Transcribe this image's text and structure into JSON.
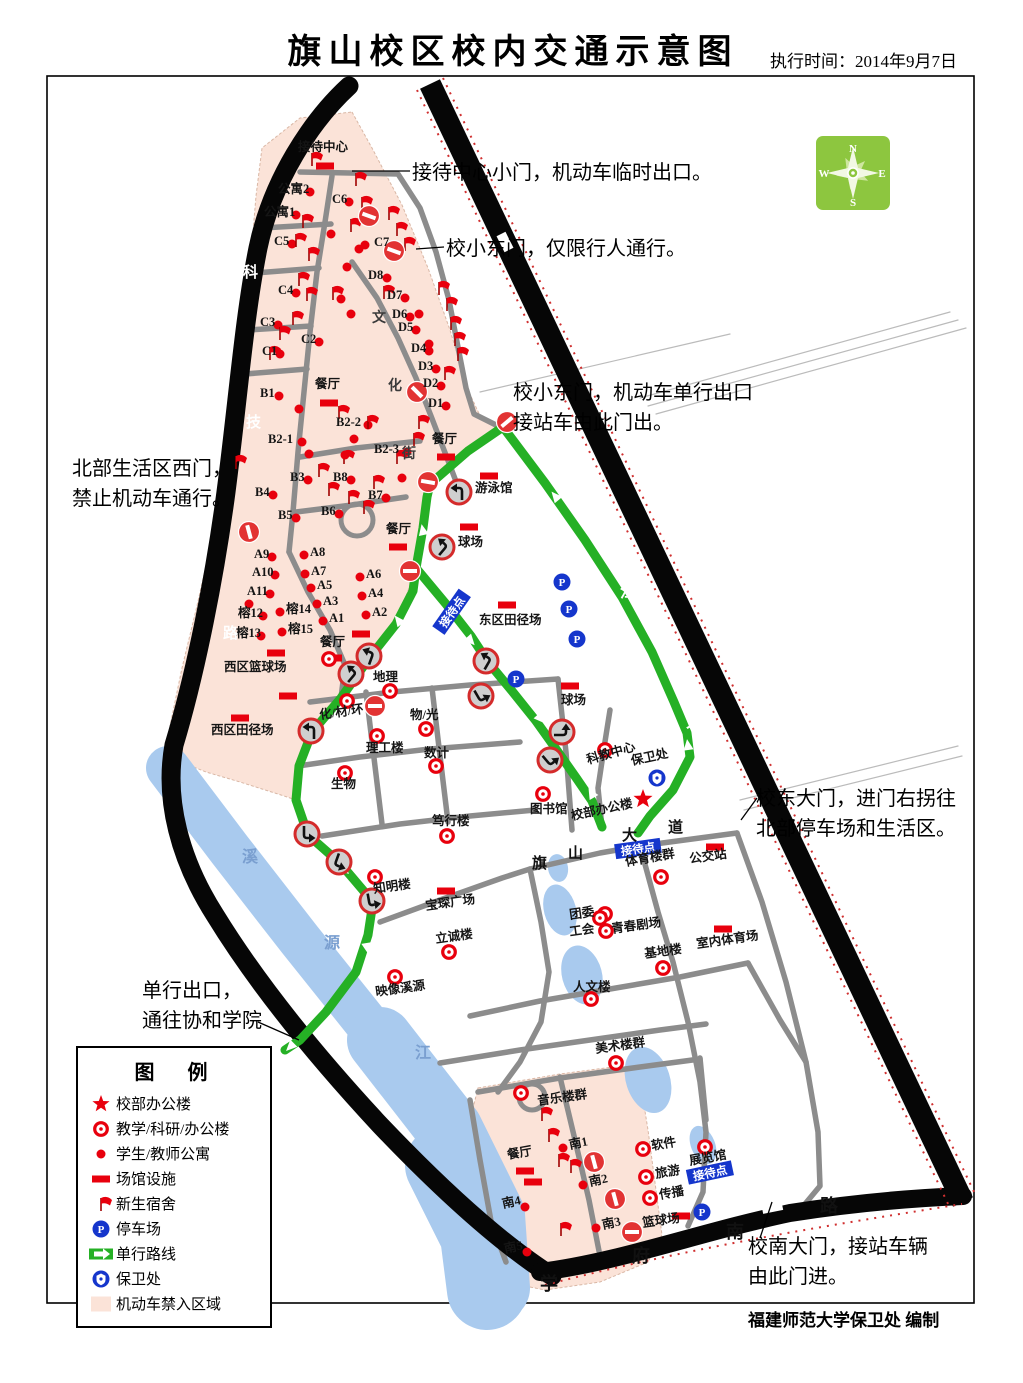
{
  "title": "旗山校区校内交通示意图",
  "subtitle": "执行时间：2014年9月7日",
  "credit": "福建师范大学保卫处  编制",
  "compass": {
    "n": "N",
    "e": "E",
    "s": "S",
    "w": "W"
  },
  "colors": {
    "red": "#e8000d",
    "blue": "#1536cc",
    "green_route": "#25b025",
    "pink_zone": "#fbe3d8",
    "river": "#a9caee",
    "road_black": "#060606",
    "road_gray": "#8c8c8c",
    "compass_green": "#8dc63f"
  },
  "legend": {
    "title": "图  例",
    "items": [
      {
        "icon": "star",
        "label": "校部办公楼"
      },
      {
        "icon": "donut",
        "label": "教学/科研/办公楼"
      },
      {
        "icon": "dot",
        "label": "学生/教师公寓"
      },
      {
        "icon": "rect",
        "label": "场馆设施"
      },
      {
        "icon": "flag",
        "label": "新生宿舍"
      },
      {
        "icon": "p",
        "label": "停车场"
      },
      {
        "icon": "oneway",
        "label": "单行路线"
      },
      {
        "icon": "badge",
        "label": "保卫处"
      },
      {
        "icon": "zone",
        "label": "机动车禁入区域"
      }
    ]
  },
  "annotations": [
    {
      "x": 412,
      "y": 158,
      "lines": [
        "接待中心小门，机动车临时出口。"
      ]
    },
    {
      "x": 446,
      "y": 234,
      "lines": [
        "校小东门，仅限行人通行。"
      ]
    },
    {
      "x": 513,
      "y": 378,
      "lines": [
        "校小东门，机动车单行出口",
        "接站车由此门出。"
      ]
    },
    {
      "x": 72,
      "y": 454,
      "lines": [
        "北部生活区西门，",
        "禁止机动车通行。"
      ]
    },
    {
      "x": 756,
      "y": 784,
      "lines": [
        "校东大门，进门右拐往",
        "北部停车场和生活区。"
      ]
    },
    {
      "x": 142,
      "y": 976,
      "lines": [
        "单行出口，",
        "通往协和学院"
      ]
    },
    {
      "x": 748,
      "y": 1232,
      "lines": [
        "校南大门，接站车辆",
        "由此门进。"
      ]
    }
  ],
  "road_chars": [
    {
      "ch": "乌",
      "x": 586,
      "y": 289,
      "c": "#ffffff",
      "s": 16
    },
    {
      "ch": "龙",
      "x": 552,
      "y": 460,
      "c": "#ffffff",
      "s": 16
    },
    {
      "ch": "江",
      "x": 620,
      "y": 597,
      "c": "#ffffff",
      "s": 16
    },
    {
      "ch": "大",
      "x": 686,
      "y": 727,
      "c": "#ffffff",
      "s": 16
    },
    {
      "ch": "道",
      "x": 772,
      "y": 907,
      "c": "#ffffff",
      "s": 16
    },
    {
      "ch": "科",
      "x": 243,
      "y": 277,
      "c": "#ffffff",
      "s": 15
    },
    {
      "ch": "技",
      "x": 246,
      "y": 427,
      "c": "#ffffff",
      "s": 15
    },
    {
      "ch": "路",
      "x": 223,
      "y": 638,
      "c": "#ffffff",
      "s": 15
    },
    {
      "ch": "学",
      "x": 540,
      "y": 1290,
      "c": "#111111",
      "s": 18
    },
    {
      "ch": "府",
      "x": 632,
      "y": 1262,
      "c": "#111111",
      "s": 18
    },
    {
      "ch": "南",
      "x": 726,
      "y": 1238,
      "c": "#111111",
      "s": 18
    },
    {
      "ch": "路",
      "x": 820,
      "y": 1212,
      "c": "#111111",
      "s": 18
    },
    {
      "ch": "文",
      "x": 372,
      "y": 322,
      "c": "#3a3a3a",
      "s": 14
    },
    {
      "ch": "化",
      "x": 388,
      "y": 390,
      "c": "#3a3a3a",
      "s": 14
    },
    {
      "ch": "街",
      "x": 402,
      "y": 458,
      "c": "#3a3a3a",
      "s": 14
    },
    {
      "ch": "旗",
      "x": 532,
      "y": 868,
      "c": "#111111",
      "s": 15
    },
    {
      "ch": "山",
      "x": 568,
      "y": 858,
      "c": "#111111",
      "s": 15
    },
    {
      "ch": "大",
      "x": 622,
      "y": 840,
      "c": "#111111",
      "s": 15
    },
    {
      "ch": "道",
      "x": 668,
      "y": 832,
      "c": "#111111",
      "s": 15
    },
    {
      "ch": "溪",
      "x": 242,
      "y": 862,
      "c": "#7a9fd0",
      "s": 16
    },
    {
      "ch": "源",
      "x": 324,
      "y": 948,
      "c": "#7a9fd0",
      "s": 16
    },
    {
      "ch": "江",
      "x": 415,
      "y": 1058,
      "c": "#7a9fd0",
      "s": 16
    }
  ],
  "map": {
    "labels": [
      [
        "接待中心",
        298,
        147,
        "rect",
        325,
        166,
        0
      ],
      [
        "公寓2",
        278,
        189,
        "dot",
        310,
        192,
        0
      ],
      [
        "公寓1",
        264,
        212,
        "dot",
        296,
        215,
        0
      ],
      [
        "C6",
        332,
        199,
        "dot",
        349,
        202,
        0
      ],
      [
        "C5",
        274,
        241,
        "dot",
        292,
        244,
        0
      ],
      [
        "C7",
        374,
        242,
        "dot",
        365,
        245,
        0
      ],
      [
        "C4",
        278,
        290,
        "dot",
        296,
        293,
        0
      ],
      [
        "C3",
        260,
        322,
        "dot",
        278,
        325,
        0
      ],
      [
        "C2",
        301,
        339,
        "dot",
        319,
        342,
        0
      ],
      [
        "C1",
        262,
        351,
        "dot",
        280,
        354,
        0
      ],
      [
        "D8",
        368,
        275,
        "dot",
        387,
        278,
        0
      ],
      [
        "D7",
        387,
        295,
        "dot",
        405,
        298,
        0
      ],
      [
        "D6",
        392,
        314,
        "dot",
        410,
        317,
        0
      ],
      [
        "D5",
        398,
        327,
        "dot",
        416,
        330,
        0
      ],
      [
        "D4",
        411,
        348,
        "dot",
        429,
        351,
        0
      ],
      [
        "D3",
        418,
        366,
        "dot",
        436,
        369,
        0
      ],
      [
        "D2",
        423,
        383,
        "dot",
        441,
        386,
        0
      ],
      [
        "D1",
        428,
        403,
        "dot",
        446,
        406,
        0
      ],
      [
        "B1",
        260,
        393,
        "dot",
        279,
        396,
        0
      ],
      [
        "餐厅",
        315,
        384,
        "rect",
        329,
        403,
        0
      ],
      [
        "B2-2",
        336,
        422,
        "dot",
        368,
        425,
        0
      ],
      [
        "B2-1",
        268,
        439,
        "dot",
        302,
        442,
        0
      ],
      [
        "B2-3",
        374,
        449,
        "dot",
        407,
        452,
        0
      ],
      [
        "餐厅",
        432,
        439,
        "rect",
        446,
        457,
        0
      ],
      [
        "B3",
        290,
        477,
        "dot",
        308,
        480,
        0
      ],
      [
        "B8",
        333,
        477,
        "dot",
        351,
        480,
        0
      ],
      [
        "B7",
        368,
        495,
        "dot",
        386,
        498,
        0
      ],
      [
        "B4",
        255,
        492,
        "dot",
        273,
        495,
        0
      ],
      [
        "B5",
        278,
        515,
        "dot",
        296,
        518,
        0
      ],
      [
        "B6",
        321,
        511,
        "dot",
        339,
        514,
        0
      ],
      [
        "餐厅",
        386,
        529,
        "rect",
        398,
        547,
        0
      ],
      [
        "A9",
        254,
        554,
        "dot",
        272,
        557,
        0
      ],
      [
        "A10",
        252,
        572,
        "dot",
        275,
        575,
        0
      ],
      [
        "A11",
        247,
        591,
        "dot",
        270,
        594,
        0
      ],
      [
        "榕12",
        238,
        613,
        "dot",
        263,
        616,
        0
      ],
      [
        "榕13",
        236,
        633,
        "dot",
        261,
        636,
        0
      ],
      [
        "榕14",
        286,
        609,
        "dot",
        280,
        612,
        0
      ],
      [
        "榕15",
        288,
        629,
        "dot",
        282,
        632,
        0
      ],
      [
        "A8",
        310,
        552,
        "dot",
        304,
        555,
        0
      ],
      [
        "A7",
        311,
        571,
        "dot",
        305,
        574,
        0
      ],
      [
        "A5",
        317,
        585,
        "dot",
        311,
        588,
        0
      ],
      [
        "A3",
        323,
        601,
        "dot",
        317,
        604,
        0
      ],
      [
        "A1",
        329,
        618,
        "dot",
        323,
        621,
        0
      ],
      [
        "A6",
        366,
        574,
        "dot",
        360,
        577,
        0
      ],
      [
        "A4",
        368,
        593,
        "dot",
        362,
        596,
        0
      ],
      [
        "A2",
        372,
        612,
        "dot",
        366,
        615,
        0
      ],
      [
        "餐厅",
        320,
        642,
        "rect",
        333,
        658,
        0
      ],
      [
        "西区篮球场",
        224,
        667,
        "rect",
        276,
        653,
        0
      ],
      [
        "西区田径场",
        211,
        730,
        "rect",
        240,
        718,
        0
      ],
      [
        "游泳馆",
        475,
        488,
        "rect",
        489,
        476,
        0
      ],
      [
        "球场",
        458,
        542,
        "rect",
        469,
        527,
        0
      ],
      [
        "东区田径场",
        479,
        620,
        "rect",
        507,
        605,
        0
      ],
      [
        "球场",
        561,
        700,
        "rect",
        570,
        686,
        0
      ],
      [
        "地理",
        373,
        677,
        "donut",
        390,
        691,
        0
      ],
      [
        "化/材/环",
        320,
        715,
        "donut",
        347,
        701,
        -8
      ],
      [
        "物/光",
        410,
        715,
        "donut",
        426,
        729,
        0
      ],
      [
        "理工楼",
        366,
        748,
        "donut",
        377,
        736,
        0
      ],
      [
        "数计",
        424,
        753,
        "donut",
        436,
        766,
        0
      ],
      [
        "生物",
        331,
        784,
        "donut",
        345,
        773,
        0
      ],
      [
        "笃行楼",
        432,
        821,
        "donut",
        447,
        836,
        0
      ],
      [
        "图书馆",
        530,
        809,
        "donut",
        543,
        794,
        0
      ],
      [
        "知明楼",
        374,
        889,
        "donut",
        375,
        877,
        -8
      ],
      [
        "宝琛广场",
        426,
        906,
        "rect",
        446,
        891,
        -8
      ],
      [
        "立诚楼",
        436,
        939,
        "donut",
        449,
        952,
        -8
      ],
      [
        "映像溪源",
        376,
        992,
        "donut",
        395,
        977,
        -8
      ],
      [
        "人文楼",
        573,
        987,
        "donut",
        591,
        999,
        0
      ],
      [
        "基地楼",
        645,
        954,
        "donut",
        663,
        968,
        -8
      ],
      [
        "室内体育场",
        697,
        944,
        "rect",
        723,
        929,
        -8
      ],
      [
        "美术楼群",
        596,
        1049,
        "donut",
        616,
        1063,
        -8
      ],
      [
        "音乐楼群",
        538,
        1101,
        "donut",
        521,
        1093,
        -8
      ],
      [
        "科教中心",
        588,
        760,
        "donut",
        605,
        750,
        -16
      ],
      [
        "保卫处",
        632,
        761,
        "badge",
        657,
        778,
        -12
      ],
      [
        "校部办公楼",
        572,
        816,
        "star",
        643,
        799,
        -12
      ],
      [
        "体育楼群",
        626,
        862,
        "donut",
        661,
        877,
        -10
      ],
      [
        "公交站",
        690,
        859,
        "rect",
        715,
        847,
        -8
      ],
      [
        "团委",
        570,
        915,
        "donut",
        605,
        914,
        -8
      ],
      [
        "工会",
        570,
        932,
        "donut",
        606,
        931,
        -8
      ],
      [
        "青春剧场",
        612,
        929,
        "donut",
        600,
        918,
        -8
      ],
      [
        "餐厅",
        508,
        1155,
        "rect",
        525,
        1171,
        -10
      ],
      [
        "南1",
        570,
        1145,
        "dot",
        563,
        1148,
        -12
      ],
      [
        "南2",
        590,
        1182,
        "dot",
        583,
        1185,
        -12
      ],
      [
        "南3",
        603,
        1225,
        "dot",
        596,
        1228,
        -12
      ],
      [
        "南4",
        503,
        1204,
        "dot",
        525,
        1207,
        -12
      ],
      [
        "南5",
        505,
        1249,
        "dot",
        527,
        1252,
        -12
      ],
      [
        "软件",
        652,
        1146,
        "donut",
        643,
        1149,
        -10
      ],
      [
        "旅游",
        656,
        1174,
        "donut",
        646,
        1177,
        -10
      ],
      [
        "传播",
        660,
        1195,
        "donut",
        650,
        1198,
        -10
      ],
      [
        "展览馆",
        690,
        1161,
        "donut",
        705,
        1147,
        -10
      ],
      [
        "篮球场",
        643,
        1223,
        "rect",
        681,
        1216,
        -8
      ]
    ],
    "flags": [
      [
        312,
        166
      ],
      [
        356,
        186
      ],
      [
        362,
        210
      ],
      [
        351,
        232
      ],
      [
        303,
        228
      ],
      [
        296,
        247
      ],
      [
        309,
        261
      ],
      [
        299,
        286
      ],
      [
        307,
        301
      ],
      [
        389,
        220
      ],
      [
        397,
        236
      ],
      [
        405,
        251
      ],
      [
        439,
        295
      ],
      [
        447,
        311
      ],
      [
        451,
        330
      ],
      [
        455,
        346
      ],
      [
        458,
        361
      ],
      [
        445,
        380
      ],
      [
        333,
        300
      ],
      [
        293,
        325
      ],
      [
        280,
        340
      ],
      [
        270,
        360
      ],
      [
        339,
        419
      ],
      [
        368,
        429
      ],
      [
        419,
        429
      ],
      [
        414,
        446
      ],
      [
        397,
        464
      ],
      [
        344,
        464
      ],
      [
        319,
        477
      ],
      [
        329,
        496
      ],
      [
        349,
        504
      ],
      [
        364,
        514
      ],
      [
        374,
        489
      ],
      [
        236,
        469
      ],
      [
        384,
        299
      ],
      [
        542,
        1121
      ],
      [
        549,
        1142
      ],
      [
        559,
        1167
      ],
      [
        571,
        1173
      ],
      [
        561,
        1236
      ]
    ],
    "extra_dots": [
      [
        331,
        234
      ],
      [
        359,
        249
      ],
      [
        347,
        267
      ],
      [
        341,
        299
      ],
      [
        351,
        314
      ],
      [
        419,
        314
      ],
      [
        429,
        344
      ],
      [
        299,
        409
      ],
      [
        309,
        454
      ],
      [
        354,
        439
      ],
      [
        249,
        604
      ],
      [
        345,
        455
      ],
      [
        402,
        478
      ]
    ],
    "extra_rects": [
      [
        361,
        634
      ],
      [
        533,
        1182
      ],
      [
        288,
        696
      ]
    ],
    "extra_donuts": [
      [
        329,
        659
      ]
    ],
    "parking": {
      "label": "P",
      "positions": [
        [
          562,
          582
        ],
        [
          569,
          609
        ],
        [
          577,
          639
        ],
        [
          516,
          679
        ],
        [
          702,
          1212
        ]
      ]
    },
    "reception_tags": {
      "text": "接待点",
      "positions": [
        [
          452,
          612,
          -55
        ],
        [
          638,
          849,
          -8
        ],
        [
          710,
          1173,
          -12
        ]
      ]
    },
    "no_entry": [
      [
        369,
        216,
        20
      ],
      [
        394,
        251,
        20
      ],
      [
        417,
        392,
        45
      ],
      [
        249,
        532,
        75
      ],
      [
        507,
        422,
        -40
      ],
      [
        428,
        482,
        10
      ],
      [
        410,
        571,
        0
      ],
      [
        375,
        706,
        0
      ],
      [
        594,
        1162,
        75
      ],
      [
        615,
        1199,
        75
      ],
      [
        632,
        1232,
        0
      ]
    ],
    "turn_signs": [
      [
        459,
        492,
        0
      ],
      [
        442,
        547,
        40
      ],
      [
        486,
        661,
        30
      ],
      [
        481,
        696,
        150
      ],
      [
        369,
        656,
        20
      ],
      [
        351,
        674,
        40
      ],
      [
        311,
        731,
        0
      ],
      [
        562,
        732,
        90
      ],
      [
        550,
        760,
        140
      ],
      [
        307,
        834,
        180
      ],
      [
        339,
        862,
        200
      ],
      [
        372,
        901,
        170
      ]
    ],
    "route_arrows": [
      [
        423,
        531,
        -12
      ],
      [
        399,
        621,
        -38
      ],
      [
        344,
        869,
        135
      ],
      [
        367,
        947,
        170
      ],
      [
        291,
        1046,
        225
      ],
      [
        556,
        497,
        -40
      ],
      [
        688,
        746,
        -8
      ],
      [
        592,
        794,
        -30
      ],
      [
        540,
        718,
        138
      ],
      [
        470,
        640,
        138
      ]
    ]
  }
}
